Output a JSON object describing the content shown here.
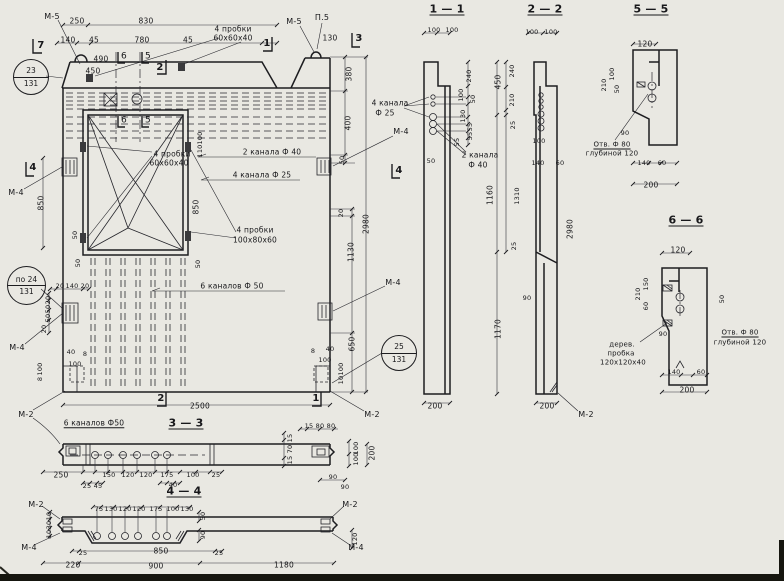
{
  "meta": {
    "kind": "technical construction drawing",
    "language": "ru",
    "subject": "Precast concrete wall panel: elevation with window opening and sections 1-1, 2-2, 3-3, 4-4, 5-5, 6-6"
  },
  "drawing": {
    "paper_color": "#e9e8e2",
    "ink_color": "#1d1d20",
    "callouts": [
      {
        "top": "23",
        "bottom": "131"
      },
      {
        "top": "по 24",
        "bottom": "131"
      },
      {
        "top": "25",
        "bottom": "131"
      }
    ],
    "labels": [
      {
        "n": "mark-m5-left",
        "t": "М-5",
        "x": 52,
        "y": 17,
        "s": 8
      },
      {
        "n": "cut-mark-7",
        "t": "7",
        "x": 41,
        "y": 46,
        "s": 10
      },
      {
        "t": "250",
        "x": 77,
        "y": 21
      },
      {
        "t": "830",
        "x": 146,
        "y": 21
      },
      {
        "t": "140",
        "x": 68,
        "y": 40
      },
      {
        "t": "45",
        "x": 94,
        "y": 40
      },
      {
        "t": "780",
        "x": 142,
        "y": 40
      },
      {
        "t": "45",
        "x": 188,
        "y": 40
      },
      {
        "t": "490",
        "x": 101,
        "y": 59
      },
      {
        "t": "450",
        "x": 93,
        "y": 71
      },
      {
        "n": "cut-mark-6-top",
        "t": "6",
        "x": 124,
        "y": 57,
        "s": 9
      },
      {
        "n": "cut-mark-5-top",
        "t": "5",
        "x": 148,
        "y": 57,
        "s": 9
      },
      {
        "n": "cut-mark-2-top",
        "t": "2",
        "x": 160,
        "y": 68,
        "s": 10
      },
      {
        "n": "cut-mark-1-top",
        "t": "1",
        "x": 267,
        "y": 44,
        "s": 10
      },
      {
        "n": "note-plugs-top",
        "t": "4 пробки",
        "x": 233,
        "y": 29
      },
      {
        "t": "60х60х40",
        "x": 233,
        "y": 38
      },
      {
        "n": "mark-m5-right",
        "t": "М-5",
        "x": 294,
        "y": 22,
        "s": 8
      },
      {
        "n": "mark-p5",
        "t": "П.5",
        "x": 322,
        "y": 18,
        "s": 8
      },
      {
        "t": "130",
        "x": 330,
        "y": 38
      },
      {
        "n": "cut-mark-3",
        "t": "3",
        "x": 359,
        "y": 39,
        "s": 10
      },
      {
        "t": "380",
        "x": 349,
        "y": 74,
        "r": 1
      },
      {
        "t": "400",
        "x": 348,
        "y": 123,
        "r": 1
      },
      {
        "t": "50",
        "x": 342,
        "y": 160,
        "r": 1,
        "s": 6.5
      },
      {
        "t": "20",
        "x": 341,
        "y": 213,
        "r": 1,
        "s": 6.5
      },
      {
        "t": "1130",
        "x": 351,
        "y": 252,
        "r": 1
      },
      {
        "t": "650",
        "x": 352,
        "y": 344,
        "r": 1
      },
      {
        "t": "2980",
        "x": 366,
        "y": 224,
        "r": 1
      },
      {
        "n": "mark-m4-right-top",
        "t": "М-4",
        "x": 401,
        "y": 132,
        "s": 8
      },
      {
        "n": "cut-mark-4-right",
        "t": "4",
        "x": 399,
        "y": 171,
        "s": 10
      },
      {
        "n": "mark-m4-right-mid",
        "t": "М-4",
        "x": 393,
        "y": 283,
        "s": 8
      },
      {
        "n": "note-channels-f40",
        "t": "2 канала Ф 40",
        "x": 272,
        "y": 152
      },
      {
        "n": "note-channels-f25",
        "t": "4 канала Ф 25",
        "x": 262,
        "y": 175
      },
      {
        "n": "note-plugs-window",
        "t": "4 пробки",
        "x": 172,
        "y": 154
      },
      {
        "t": "60х60х40",
        "x": 169,
        "y": 163
      },
      {
        "n": "cut-mark-6-win",
        "t": "6",
        "x": 124,
        "y": 121,
        "s": 9
      },
      {
        "n": "cut-mark-5-win",
        "t": "5",
        "x": 148,
        "y": 121,
        "s": 9
      },
      {
        "n": "note-plugs-100",
        "t": "4 пробки",
        "x": 255,
        "y": 230
      },
      {
        "t": "100х80х60",
        "x": 255,
        "y": 240
      },
      {
        "n": "note-channels-f50",
        "t": "6 каналов Ф 50",
        "x": 232,
        "y": 286
      },
      {
        "t": "850",
        "x": 196,
        "y": 207,
        "r": 1
      },
      {
        "t": "50",
        "x": 198,
        "y": 264,
        "r": 1,
        "s": 6.5
      },
      {
        "t": "100",
        "x": 200,
        "y": 138,
        "r": 1,
        "s": 6.5
      },
      {
        "t": "110",
        "x": 200,
        "y": 151,
        "r": 1,
        "s": 6.5
      },
      {
        "n": "cut-mark-4-left",
        "t": "4",
        "x": 33,
        "y": 168,
        "s": 10
      },
      {
        "n": "mark-m4-left-top",
        "t": "М-4",
        "x": 16,
        "y": 193,
        "s": 8
      },
      {
        "t": "850",
        "x": 41,
        "y": 203,
        "r": 1
      },
      {
        "t": "50",
        "x": 75,
        "y": 235,
        "r": 1,
        "s": 6.5
      },
      {
        "t": "50",
        "x": 78,
        "y": 263,
        "r": 1,
        "s": 6.5
      },
      {
        "t": "20",
        "x": 60,
        "y": 286,
        "s": 6.5
      },
      {
        "t": "140",
        "x": 72,
        "y": 286,
        "s": 6.5
      },
      {
        "t": "20",
        "x": 85,
        "y": 286,
        "s": 6.5
      },
      {
        "t": "20",
        "x": 48,
        "y": 300,
        "r": 1,
        "s": 6.5
      },
      {
        "t": "50",
        "x": 48,
        "y": 309,
        "r": 1,
        "s": 6.5
      },
      {
        "t": "50",
        "x": 48,
        "y": 318,
        "r": 1,
        "s": 6.5
      },
      {
        "t": "20",
        "x": 44,
        "y": 329,
        "r": 1,
        "s": 6.5
      },
      {
        "n": "mark-m4-left-bot",
        "t": "М-4",
        "x": 17,
        "y": 348,
        "s": 8
      },
      {
        "t": "40",
        "x": 71,
        "y": 352,
        "s": 6.5
      },
      {
        "t": "8",
        "x": 85,
        "y": 354,
        "s": 6.5
      },
      {
        "t": "100",
        "x": 75,
        "y": 364,
        "s": 6.5
      },
      {
        "t": "100",
        "x": 40,
        "y": 369,
        "r": 1,
        "s": 6.5
      },
      {
        "t": "8",
        "x": 40,
        "y": 379,
        "r": 1,
        "s": 6.5
      },
      {
        "n": "mark-m2-left",
        "t": "М-2",
        "x": 26,
        "y": 415,
        "s": 8
      },
      {
        "n": "cut-mark-2-bot",
        "t": "2",
        "x": 161,
        "y": 399,
        "s": 10
      },
      {
        "n": "cut-mark-1-bot",
        "t": "1",
        "x": 316,
        "y": 399,
        "s": 10
      },
      {
        "t": "2500",
        "x": 200,
        "y": 406
      },
      {
        "t": "8",
        "x": 313,
        "y": 351,
        "s": 6.5
      },
      {
        "t": "40",
        "x": 330,
        "y": 349,
        "s": 6.5
      },
      {
        "t": "100",
        "x": 325,
        "y": 360,
        "s": 6.5
      },
      {
        "t": "100",
        "x": 341,
        "y": 369,
        "r": 1,
        "s": 6.5
      },
      {
        "t": "10",
        "x": 341,
        "y": 380,
        "r": 1,
        "s": 6.5
      },
      {
        "n": "mark-m2-right",
        "t": "М-2",
        "x": 372,
        "y": 415,
        "s": 8
      },
      {
        "n": "section-title-1-1",
        "t": "1 — 1",
        "x": 447,
        "y": 9,
        "s": 11,
        "u": 1
      },
      {
        "t": "100",
        "x": 434,
        "y": 30,
        "s": 6.5
      },
      {
        "t": "100",
        "x": 452,
        "y": 30,
        "s": 6.5
      },
      {
        "t": "240",
        "x": 469,
        "y": 76,
        "r": 1,
        "s": 6.5
      },
      {
        "t": "100",
        "x": 461,
        "y": 95,
        "r": 1,
        "s": 6.5
      },
      {
        "t": "50",
        "x": 473,
        "y": 99,
        "r": 1,
        "s": 6.5
      },
      {
        "t": "130",
        "x": 463,
        "y": 116,
        "r": 1,
        "s": 6.5
      },
      {
        "t": "55",
        "x": 470,
        "y": 127,
        "r": 1,
        "s": 6.5
      },
      {
        "t": "55",
        "x": 470,
        "y": 136,
        "r": 1,
        "s": 6.5
      },
      {
        "t": "55",
        "x": 457,
        "y": 142,
        "r": 1,
        "s": 6.5
      },
      {
        "n": "note-4-channels-f25",
        "t": "4 канала",
        "x": 390,
        "y": 103
      },
      {
        "t": "Ф 25",
        "x": 385,
        "y": 113
      },
      {
        "n": "note-2-channels-f40",
        "t": "2 канала",
        "x": 480,
        "y": 155
      },
      {
        "t": "Ф 40",
        "x": 478,
        "y": 165
      },
      {
        "t": "50",
        "x": 431,
        "y": 161,
        "s": 6.5
      },
      {
        "t": "200",
        "x": 435,
        "y": 406
      },
      {
        "n": "section-title-2-2",
        "t": "2 — 2",
        "x": 545,
        "y": 9,
        "s": 11,
        "u": 1
      },
      {
        "t": "100",
        "x": 532,
        "y": 32,
        "s": 6.5
      },
      {
        "t": "100",
        "x": 551,
        "y": 32,
        "s": 6.5
      },
      {
        "t": "450",
        "x": 498,
        "y": 82,
        "r": 1
      },
      {
        "t": "240",
        "x": 512,
        "y": 71,
        "r": 1,
        "s": 6.5
      },
      {
        "t": "210",
        "x": 512,
        "y": 100,
        "r": 1,
        "s": 6.5
      },
      {
        "t": "25",
        "x": 513,
        "y": 125,
        "r": 1,
        "s": 6.5
      },
      {
        "t": "100",
        "x": 539,
        "y": 141,
        "s": 6.5
      },
      {
        "t": "140",
        "x": 538,
        "y": 163,
        "s": 6.5
      },
      {
        "t": "60",
        "x": 560,
        "y": 163,
        "s": 6.5
      },
      {
        "t": "1160",
        "x": 490,
        "y": 195,
        "r": 1
      },
      {
        "t": "1310",
        "x": 517,
        "y": 196,
        "r": 1,
        "s": 6.5
      },
      {
        "t": "25",
        "x": 514,
        "y": 246,
        "r": 1,
        "s": 6.5
      },
      {
        "t": "90",
        "x": 527,
        "y": 298,
        "s": 6.5
      },
      {
        "t": "1170",
        "x": 498,
        "y": 329,
        "r": 1
      },
      {
        "t": "200",
        "x": 547,
        "y": 406
      },
      {
        "n": "mark-m2-sec2",
        "t": "М-2",
        "x": 586,
        "y": 415,
        "s": 8
      },
      {
        "t": "2980",
        "x": 570,
        "y": 229,
        "r": 1
      },
      {
        "n": "section-title-5-5",
        "t": "5 — 5",
        "x": 651,
        "y": 9,
        "s": 11,
        "u": 1
      },
      {
        "t": "120",
        "x": 645,
        "y": 44
      },
      {
        "t": "100",
        "x": 612,
        "y": 74,
        "r": 1,
        "s": 6.5
      },
      {
        "t": "50",
        "x": 617,
        "y": 89,
        "r": 1,
        "s": 6.5
      },
      {
        "t": "210",
        "x": 604,
        "y": 85,
        "r": 1,
        "s": 6.5
      },
      {
        "t": "90",
        "x": 625,
        "y": 133,
        "s": 6.5
      },
      {
        "n": "note-hole-5-5",
        "t": "Отв. Ф 80",
        "x": 612,
        "y": 145,
        "s": 7,
        "u": 1
      },
      {
        "t": "глубиной 120",
        "x": 612,
        "y": 154,
        "s": 7
      },
      {
        "t": "140",
        "x": 644,
        "y": 163,
        "s": 6.5
      },
      {
        "t": "60",
        "x": 662,
        "y": 163,
        "s": 6.5
      },
      {
        "t": "200",
        "x": 651,
        "y": 185
      },
      {
        "n": "section-title-6-6",
        "t": "6 — 6",
        "x": 686,
        "y": 220,
        "s": 11,
        "u": 1
      },
      {
        "t": "120",
        "x": 678,
        "y": 250
      },
      {
        "t": "150",
        "x": 646,
        "y": 284,
        "r": 1,
        "s": 6.5
      },
      {
        "t": "210",
        "x": 638,
        "y": 294,
        "r": 1,
        "s": 6.5
      },
      {
        "t": "60",
        "x": 646,
        "y": 306,
        "r": 1,
        "s": 6.5
      },
      {
        "t": "50",
        "x": 722,
        "y": 299,
        "r": 1,
        "s": 6.5
      },
      {
        "t": "90",
        "x": 663,
        "y": 334,
        "s": 6.5
      },
      {
        "n": "note-hole-6-6",
        "t": "Отв. Ф 80",
        "x": 740,
        "y": 333,
        "s": 7,
        "u": 1
      },
      {
        "t": "глубиной 120",
        "x": 740,
        "y": 343,
        "s": 7
      },
      {
        "n": "note-wood-plug",
        "t": "дерев.",
        "x": 622,
        "y": 345,
        "s": 7
      },
      {
        "t": "пробка",
        "x": 621,
        "y": 354,
        "s": 7
      },
      {
        "t": "120х120х40",
        "x": 623,
        "y": 363,
        "s": 7
      },
      {
        "t": "140",
        "x": 674,
        "y": 372,
        "s": 6.5
      },
      {
        "t": "60",
        "x": 701,
        "y": 372,
        "s": 6.5
      },
      {
        "t": "200",
        "x": 687,
        "y": 390
      },
      {
        "n": "section-title-3-3",
        "t": "3 — 3",
        "x": 186,
        "y": 423,
        "s": 11,
        "u": 1
      },
      {
        "n": "note-6-channels",
        "t": "6 каналов Ф50",
        "x": 94,
        "y": 423,
        "u": 1
      },
      {
        "t": "15",
        "x": 309,
        "y": 426,
        "s": 6.5
      },
      {
        "t": "80",
        "x": 320,
        "y": 426,
        "s": 6.5
      },
      {
        "t": "80",
        "x": 331,
        "y": 426,
        "s": 6.5
      },
      {
        "t": "15",
        "x": 290,
        "y": 438,
        "r": 1,
        "s": 6.5
      },
      {
        "t": "70",
        "x": 290,
        "y": 449,
        "r": 1,
        "s": 6.5
      },
      {
        "t": "15",
        "x": 290,
        "y": 460,
        "r": 1,
        "s": 6.5
      },
      {
        "t": "100",
        "x": 356,
        "y": 448,
        "r": 1,
        "s": 6.5
      },
      {
        "t": "100",
        "x": 356,
        "y": 459,
        "r": 1,
        "s": 6.5
      },
      {
        "t": "200",
        "x": 372,
        "y": 453,
        "r": 1
      },
      {
        "t": "90",
        "x": 333,
        "y": 477,
        "s": 6.5
      },
      {
        "t": "90",
        "x": 345,
        "y": 487,
        "s": 6.5
      },
      {
        "t": "250",
        "x": 61,
        "y": 475
      },
      {
        "t": "25",
        "x": 87,
        "y": 486,
        "s": 6.5
      },
      {
        "t": "45",
        "x": 98,
        "y": 486,
        "s": 6.5
      },
      {
        "t": "150",
        "x": 109,
        "y": 475,
        "s": 6.5
      },
      {
        "t": "120",
        "x": 128,
        "y": 475,
        "s": 6.5
      },
      {
        "t": "120",
        "x": 146,
        "y": 475,
        "s": 6.5
      },
      {
        "t": "175",
        "x": 167,
        "y": 475,
        "s": 6.5
      },
      {
        "t": "100",
        "x": 193,
        "y": 475,
        "s": 6.5
      },
      {
        "t": "40",
        "x": 173,
        "y": 485,
        "s": 6.5
      },
      {
        "t": "25",
        "x": 216,
        "y": 475,
        "s": 6.5
      },
      {
        "n": "section-title-4-4",
        "t": "4 — 4",
        "x": 184,
        "y": 491,
        "s": 11,
        "u": 1
      },
      {
        "n": "mark-m2-44-left",
        "t": "М-2",
        "x": 36,
        "y": 505,
        "s": 8
      },
      {
        "n": "mark-m2-44-right",
        "t": "М-2",
        "x": 350,
        "y": 505,
        "s": 8
      },
      {
        "t": "75",
        "x": 99,
        "y": 509,
        "s": 6.5
      },
      {
        "t": "130",
        "x": 111,
        "y": 509,
        "s": 6.5
      },
      {
        "t": "120",
        "x": 125,
        "y": 509,
        "s": 6.5
      },
      {
        "t": "120",
        "x": 139,
        "y": 509,
        "s": 6.5
      },
      {
        "t": "175",
        "x": 156,
        "y": 509,
        "s": 6.5
      },
      {
        "t": "100",
        "x": 173,
        "y": 509,
        "s": 6.5
      },
      {
        "t": "130",
        "x": 187,
        "y": 509,
        "s": 6.5
      },
      {
        "t": "10",
        "x": 49,
        "y": 516,
        "r": 1,
        "s": 6.5
      },
      {
        "t": "30",
        "x": 49,
        "y": 525,
        "r": 1,
        "s": 6.5
      },
      {
        "t": "10",
        "x": 49,
        "y": 534,
        "r": 1,
        "s": 6.5
      },
      {
        "t": "50",
        "x": 203,
        "y": 516,
        "r": 1,
        "s": 6.5
      },
      {
        "t": "90",
        "x": 203,
        "y": 535,
        "r": 1,
        "s": 6.5
      },
      {
        "t": "120",
        "x": 355,
        "y": 539,
        "r": 1,
        "s": 6.5
      },
      {
        "t": "25",
        "x": 83,
        "y": 553,
        "s": 6.5
      },
      {
        "t": "850",
        "x": 161,
        "y": 551
      },
      {
        "t": "25",
        "x": 219,
        "y": 553,
        "s": 6.5
      },
      {
        "t": "220",
        "x": 73,
        "y": 565
      },
      {
        "t": "900",
        "x": 156,
        "y": 566
      },
      {
        "t": "1180",
        "x": 284,
        "y": 565
      },
      {
        "n": "mark-m4-44-left",
        "t": "М-4",
        "x": 29,
        "y": 548,
        "s": 8
      },
      {
        "n": "mark-m4-44-right",
        "t": "М-4",
        "x": 356,
        "y": 548,
        "s": 8
      }
    ]
  }
}
